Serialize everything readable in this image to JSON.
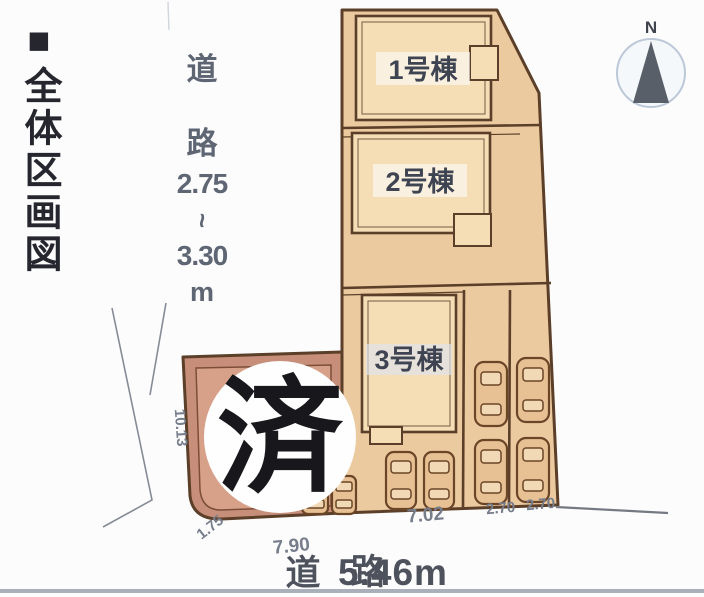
{
  "title": "■全体区画図",
  "north_label": "N",
  "left_road": {
    "char1": "道",
    "char2": "路",
    "min": "2.75",
    "tilde": "~",
    "max": "3.30",
    "unit": "m"
  },
  "bottom_road": {
    "char1": "道",
    "char2": "路",
    "width": "5.46m"
  },
  "buildings": {
    "b1": "1号棟",
    "b2": "2号棟",
    "b3": "3号棟"
  },
  "stamp_sold": "済",
  "dimensions": {
    "west_side": "10.13",
    "southwest": "1.75",
    "sold_frontage": "7.90",
    "lot3_frontage": "7.02",
    "strip1": "2.70",
    "strip2": "2.70"
  },
  "colors": {
    "parcel": "#eccaa0",
    "building": "#f5ddb6",
    "soldLot": "#c78f7a",
    "soldLotInner": "#d7a189",
    "outline": "#5b3f28",
    "carBody": "#e7c193",
    "dimText": "#767d8b",
    "roadText": "#4d525d",
    "titleText": "#26262e",
    "leftRoadText": "#5e6573"
  }
}
